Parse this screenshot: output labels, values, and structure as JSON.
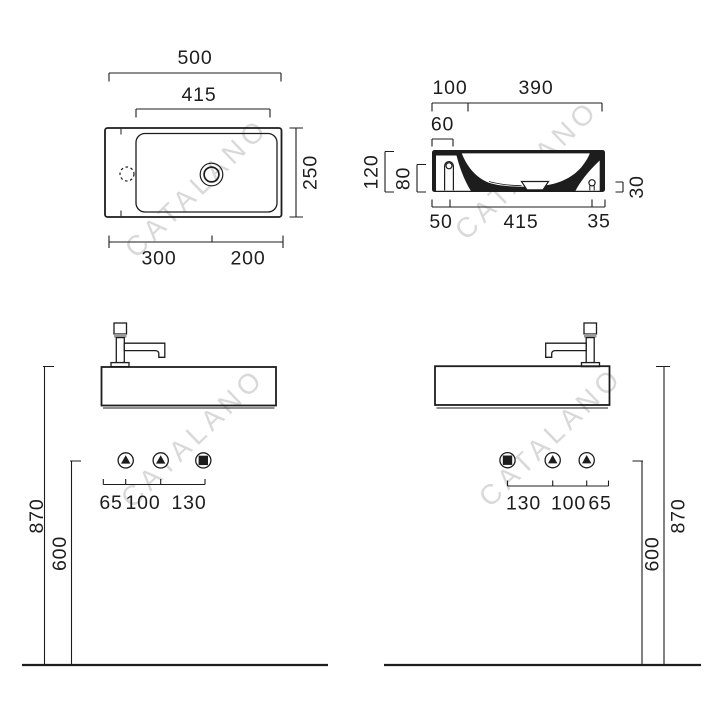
{
  "watermark": {
    "text": "CATALANO",
    "color": "#d9d9d9"
  },
  "drawing": {
    "line_color": "#1d1d1d",
    "background": "#ffffff"
  },
  "plan_view": {
    "overall_width": "500",
    "basin_width": "415",
    "overall_depth": "250",
    "bottom_left_segment": "300",
    "bottom_right_segment": "200",
    "tap_hole_icon": "dashed-circle",
    "drain_icon": "concentric-circles"
  },
  "section_view": {
    "top_back_segment": "100",
    "top_front_segment": "390",
    "tap_deck_width": "60",
    "overall_height": "120",
    "bowl_inner_height": "80",
    "outlet_height": "30",
    "bottom_back_segment": "50",
    "bottom_middle_segment": "415",
    "bottom_front_segment": "35"
  },
  "front_view_left": {
    "spacing_1": "65",
    "spacing_2": "100",
    "spacing_3": "130",
    "supply_height": "600",
    "rim_height": "870",
    "supply_icon": "triangle-in-circle",
    "waste_icon": "square-in-circle"
  },
  "front_view_right": {
    "spacing_1": "130",
    "spacing_2": "100",
    "spacing_3": "65",
    "supply_height": "600",
    "rim_height": "870",
    "supply_icon": "triangle-in-circle",
    "waste_icon": "square-in-circle"
  }
}
